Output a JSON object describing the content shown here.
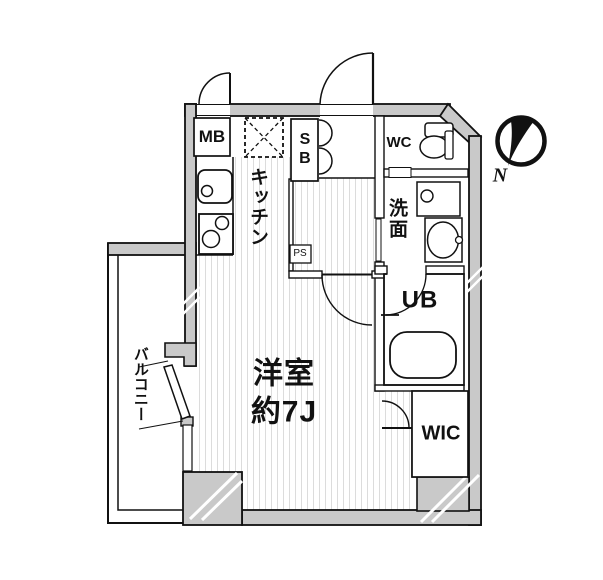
{
  "labels": {
    "mb": "MB",
    "sb": "SB",
    "kitchen": "キッチン",
    "wc": "WC",
    "washroom": "洗面",
    "ub": "UB",
    "wic": "WIC",
    "bedroom": "洋室\n約7J",
    "balcony": "バルコニー",
    "ps": "PS",
    "compass_north": "N"
  },
  "colors": {
    "wall_fill": "#c9c9c9",
    "outline": "#111111",
    "floor_stripe": "#dcdcdc",
    "background": "#ffffff"
  }
}
